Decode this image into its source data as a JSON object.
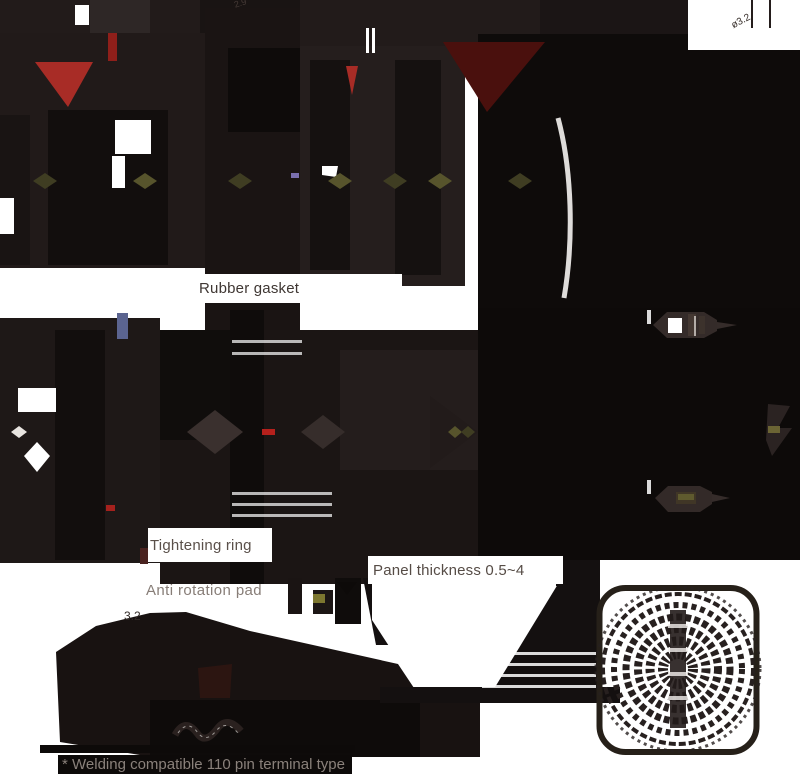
{
  "drawing": {
    "type": "technical dimension drawing of a panel-mount circular connector, rendered with heavy dark fills",
    "callouts": {
      "rubber_gasket": "Rubber gasket",
      "tightening_ring": "Tightening ring",
      "anti_rotation_pad": "Anti rotation pad",
      "panel_thickness": "Panel thickness 0.5~4"
    },
    "footnote": "* Welding compatible 110 pin terminal type",
    "dimensions": {
      "top_right": "ø3.2",
      "bottom_left": "3.2",
      "top_middle": "2.9"
    },
    "colors": {
      "background": "#ffffff",
      "ink_dark": "#0d0a09",
      "ink_mid": "#1d1716",
      "ink_soft": "#2a2221",
      "accent_red": "#a82c26",
      "accent_maroon": "#4a100d",
      "accent_olive": "#57542c",
      "accent_steel_blue": "#5b6490",
      "callout_text": "#564c46",
      "footnote_text": "#8a817b"
    }
  }
}
